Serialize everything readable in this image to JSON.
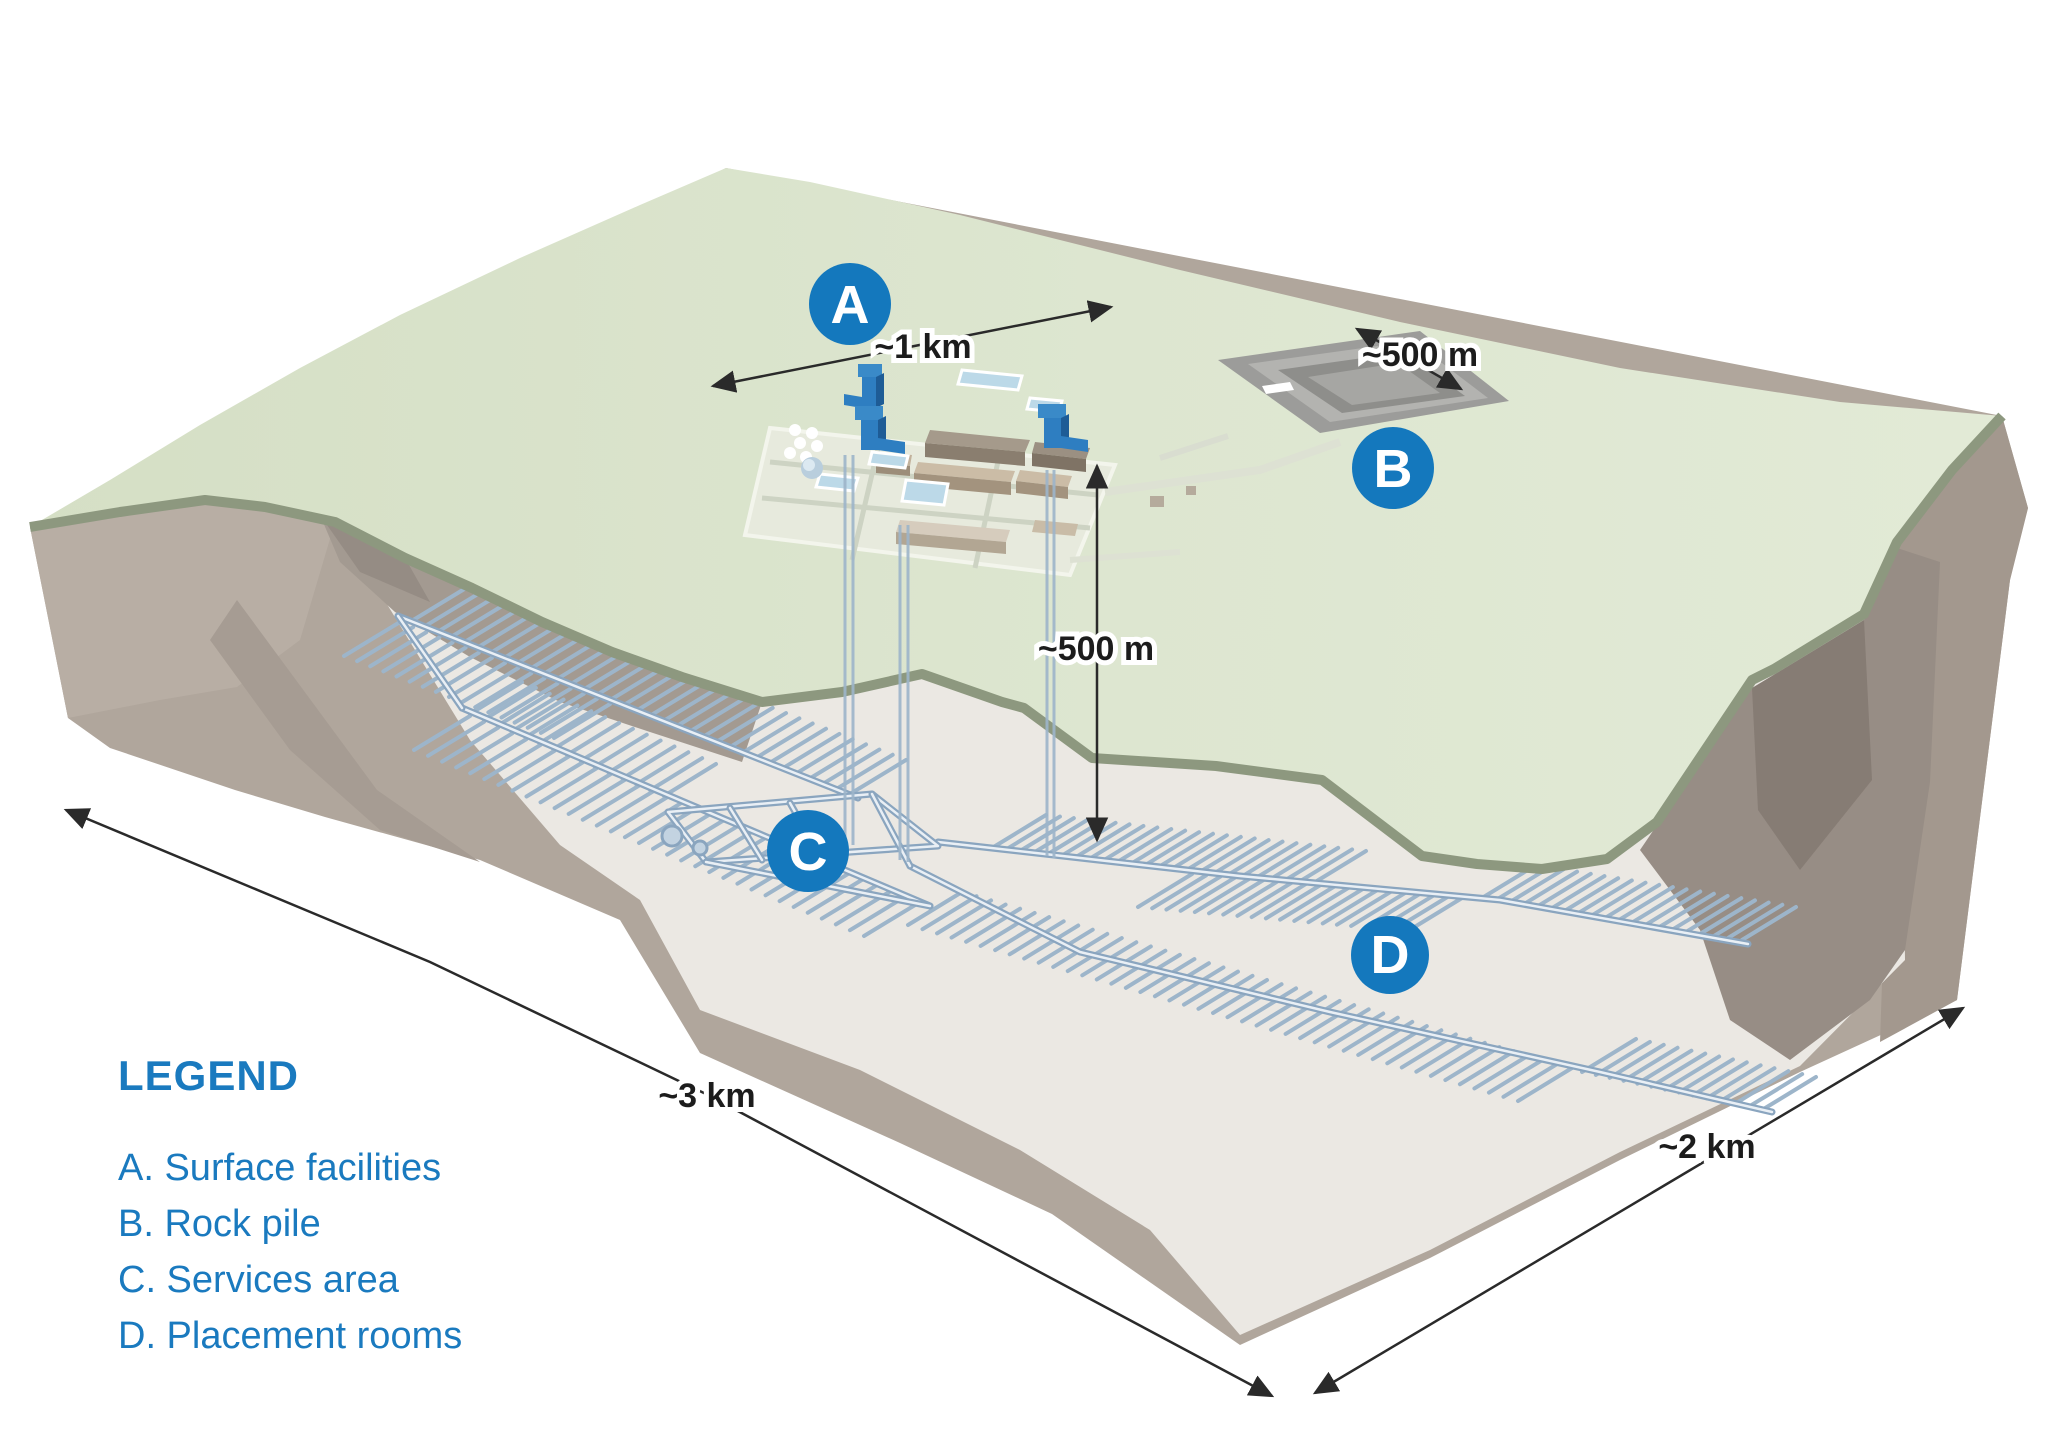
{
  "legend": {
    "title": "LEGEND",
    "items": [
      "A. Surface facilities",
      "B. Rock pile",
      "C. Services area",
      "D. Placement rooms"
    ]
  },
  "markers": {
    "a": "A",
    "b": "B",
    "c": "C",
    "d": "D"
  },
  "dimensions": {
    "surface_width": "~1 km",
    "rock_pile_width": "~500 m",
    "depth": "~500 m",
    "block_length": "~3 km",
    "block_width": "~2 km"
  },
  "colors": {
    "accent_blue": "#1a7abf",
    "marker_blue": "#1478bd",
    "surface_green": "#dce5cf",
    "rim_green": "#8d987f",
    "rock_brown": "#b0a69c",
    "floor_beige": "#ebe8e3",
    "tunnel_blue": "#8aa5bf",
    "headframe_blue": "#2e7ec1",
    "dimension_black": "#2a2a2a"
  }
}
